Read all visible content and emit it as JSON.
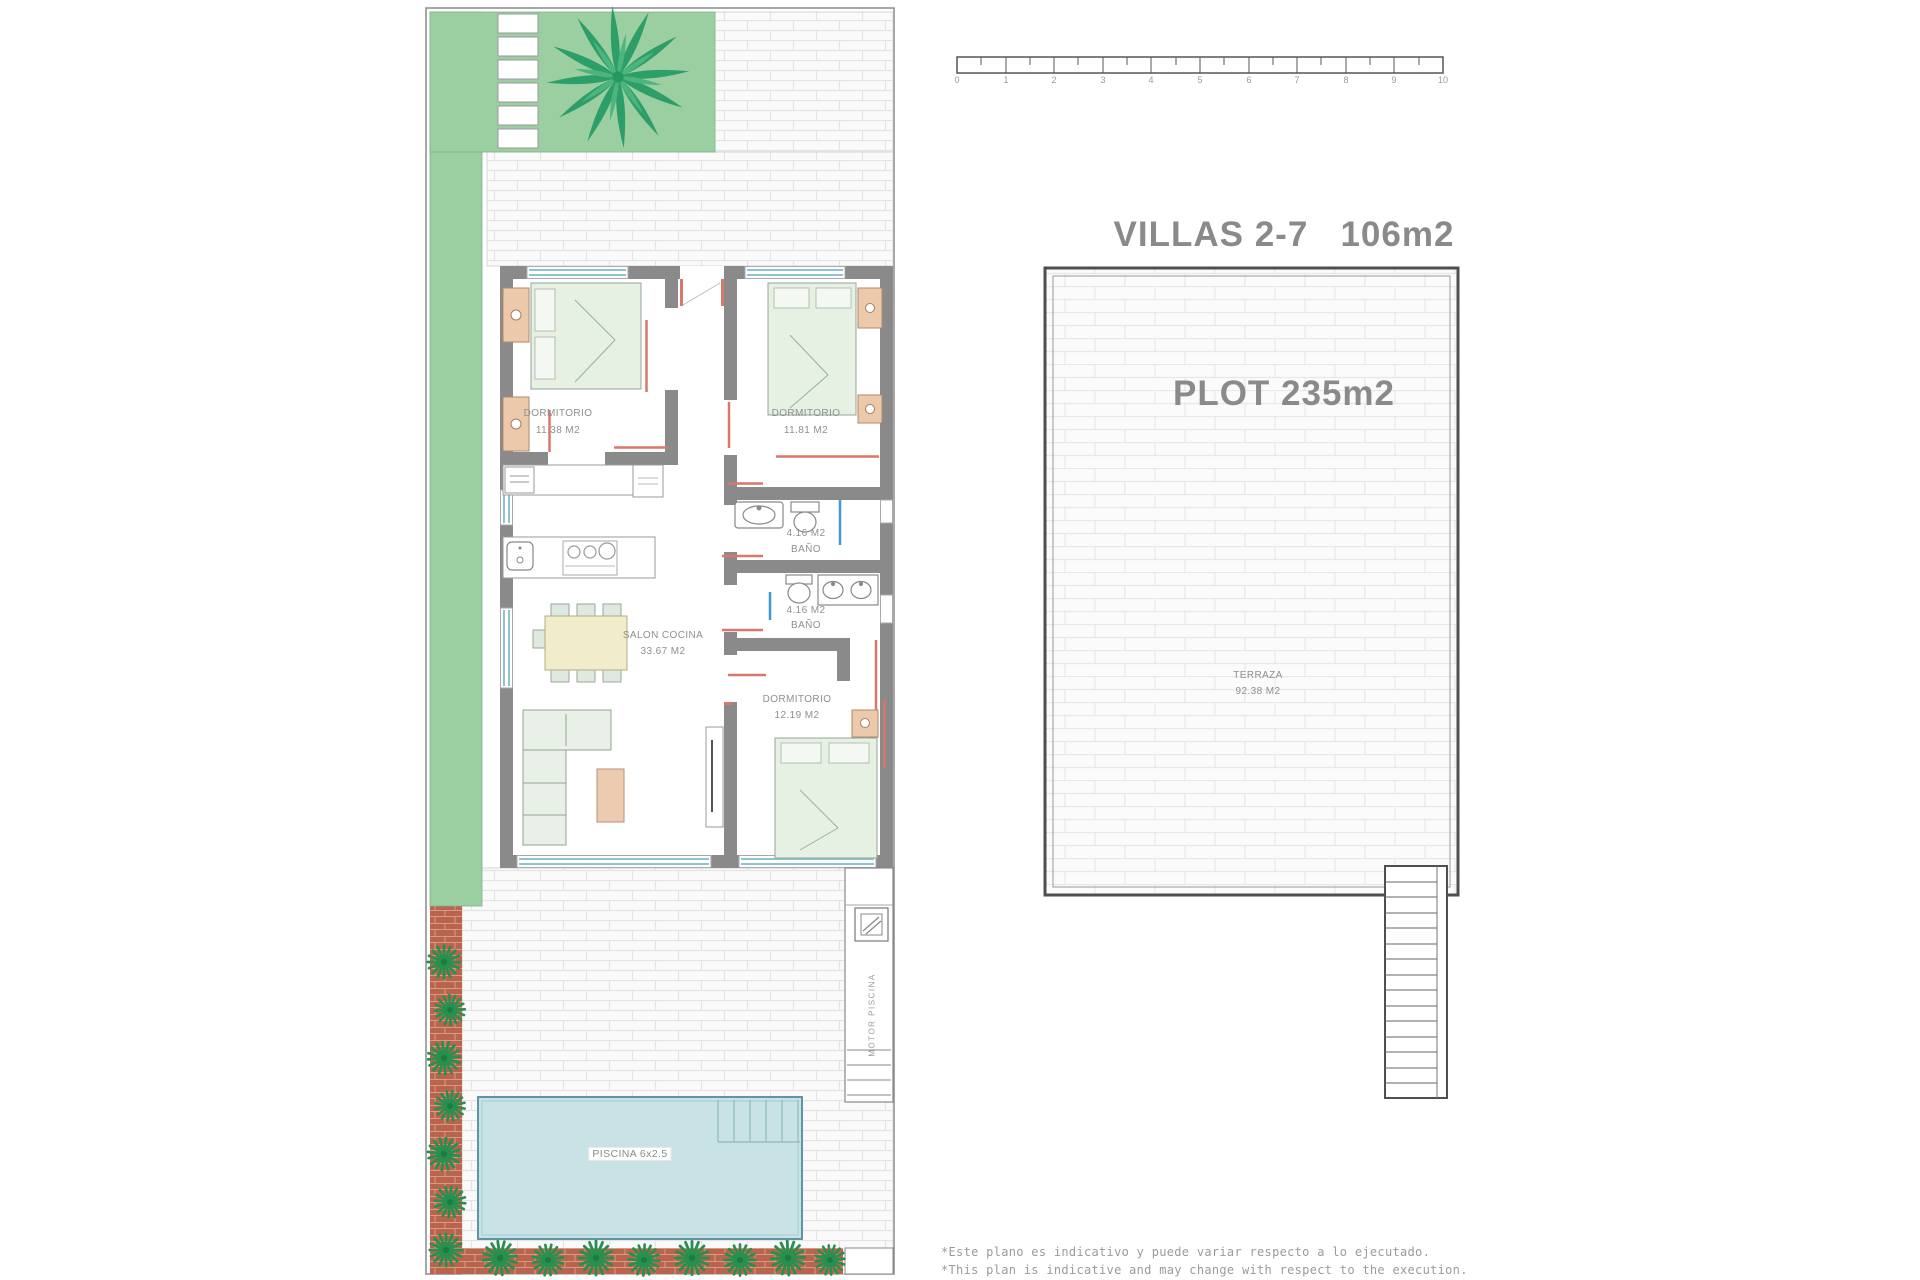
{
  "title": {
    "line1": "VILLAS 2-7   106m2",
    "line2": "PLOT 235m2"
  },
  "scale_bar": {
    "ticks": [
      "0",
      "1",
      "2",
      "3",
      "4",
      "5",
      "6",
      "7",
      "8",
      "9",
      "10"
    ]
  },
  "rooms": [
    {
      "name": "DORMITORIO",
      "area": "11.38 M2"
    },
    {
      "name": "DORMITORIO",
      "area": "11.81 M2"
    },
    {
      "area": "4.16 M2",
      "name": "BAÑO"
    },
    {
      "area": "4.16 M2",
      "name": "BAÑO"
    },
    {
      "name": "SALON COCINA",
      "area": "33.67 M2"
    },
    {
      "name": "DORMITORIO",
      "area": "12.19 M2"
    }
  ],
  "terrace": {
    "name": "TERRAZA",
    "area": "92.38 M2"
  },
  "pool": {
    "label": "PISCINA 6x2.5"
  },
  "pool_motor": {
    "label": "MOTOR PISCINA"
  },
  "disclaimer": {
    "line1": "*Este plano es indicativo y puede variar respecto a lo ejecutado.",
    "line2": "*This plan is indicative and may change with respect to the execution."
  },
  "colors": {
    "garden_green": "#9bcfa1",
    "pool_blue": "#c8e2e5",
    "terracotta": "#b9644c",
    "wall_gray": "#8a8a8a",
    "door_red": "#d9776a",
    "glass_blue": "#8fc3d4",
    "furniture_green": "#e7efe4",
    "furniture_tan": "#ecc9ab",
    "label_gray": "#8f8f8f"
  }
}
